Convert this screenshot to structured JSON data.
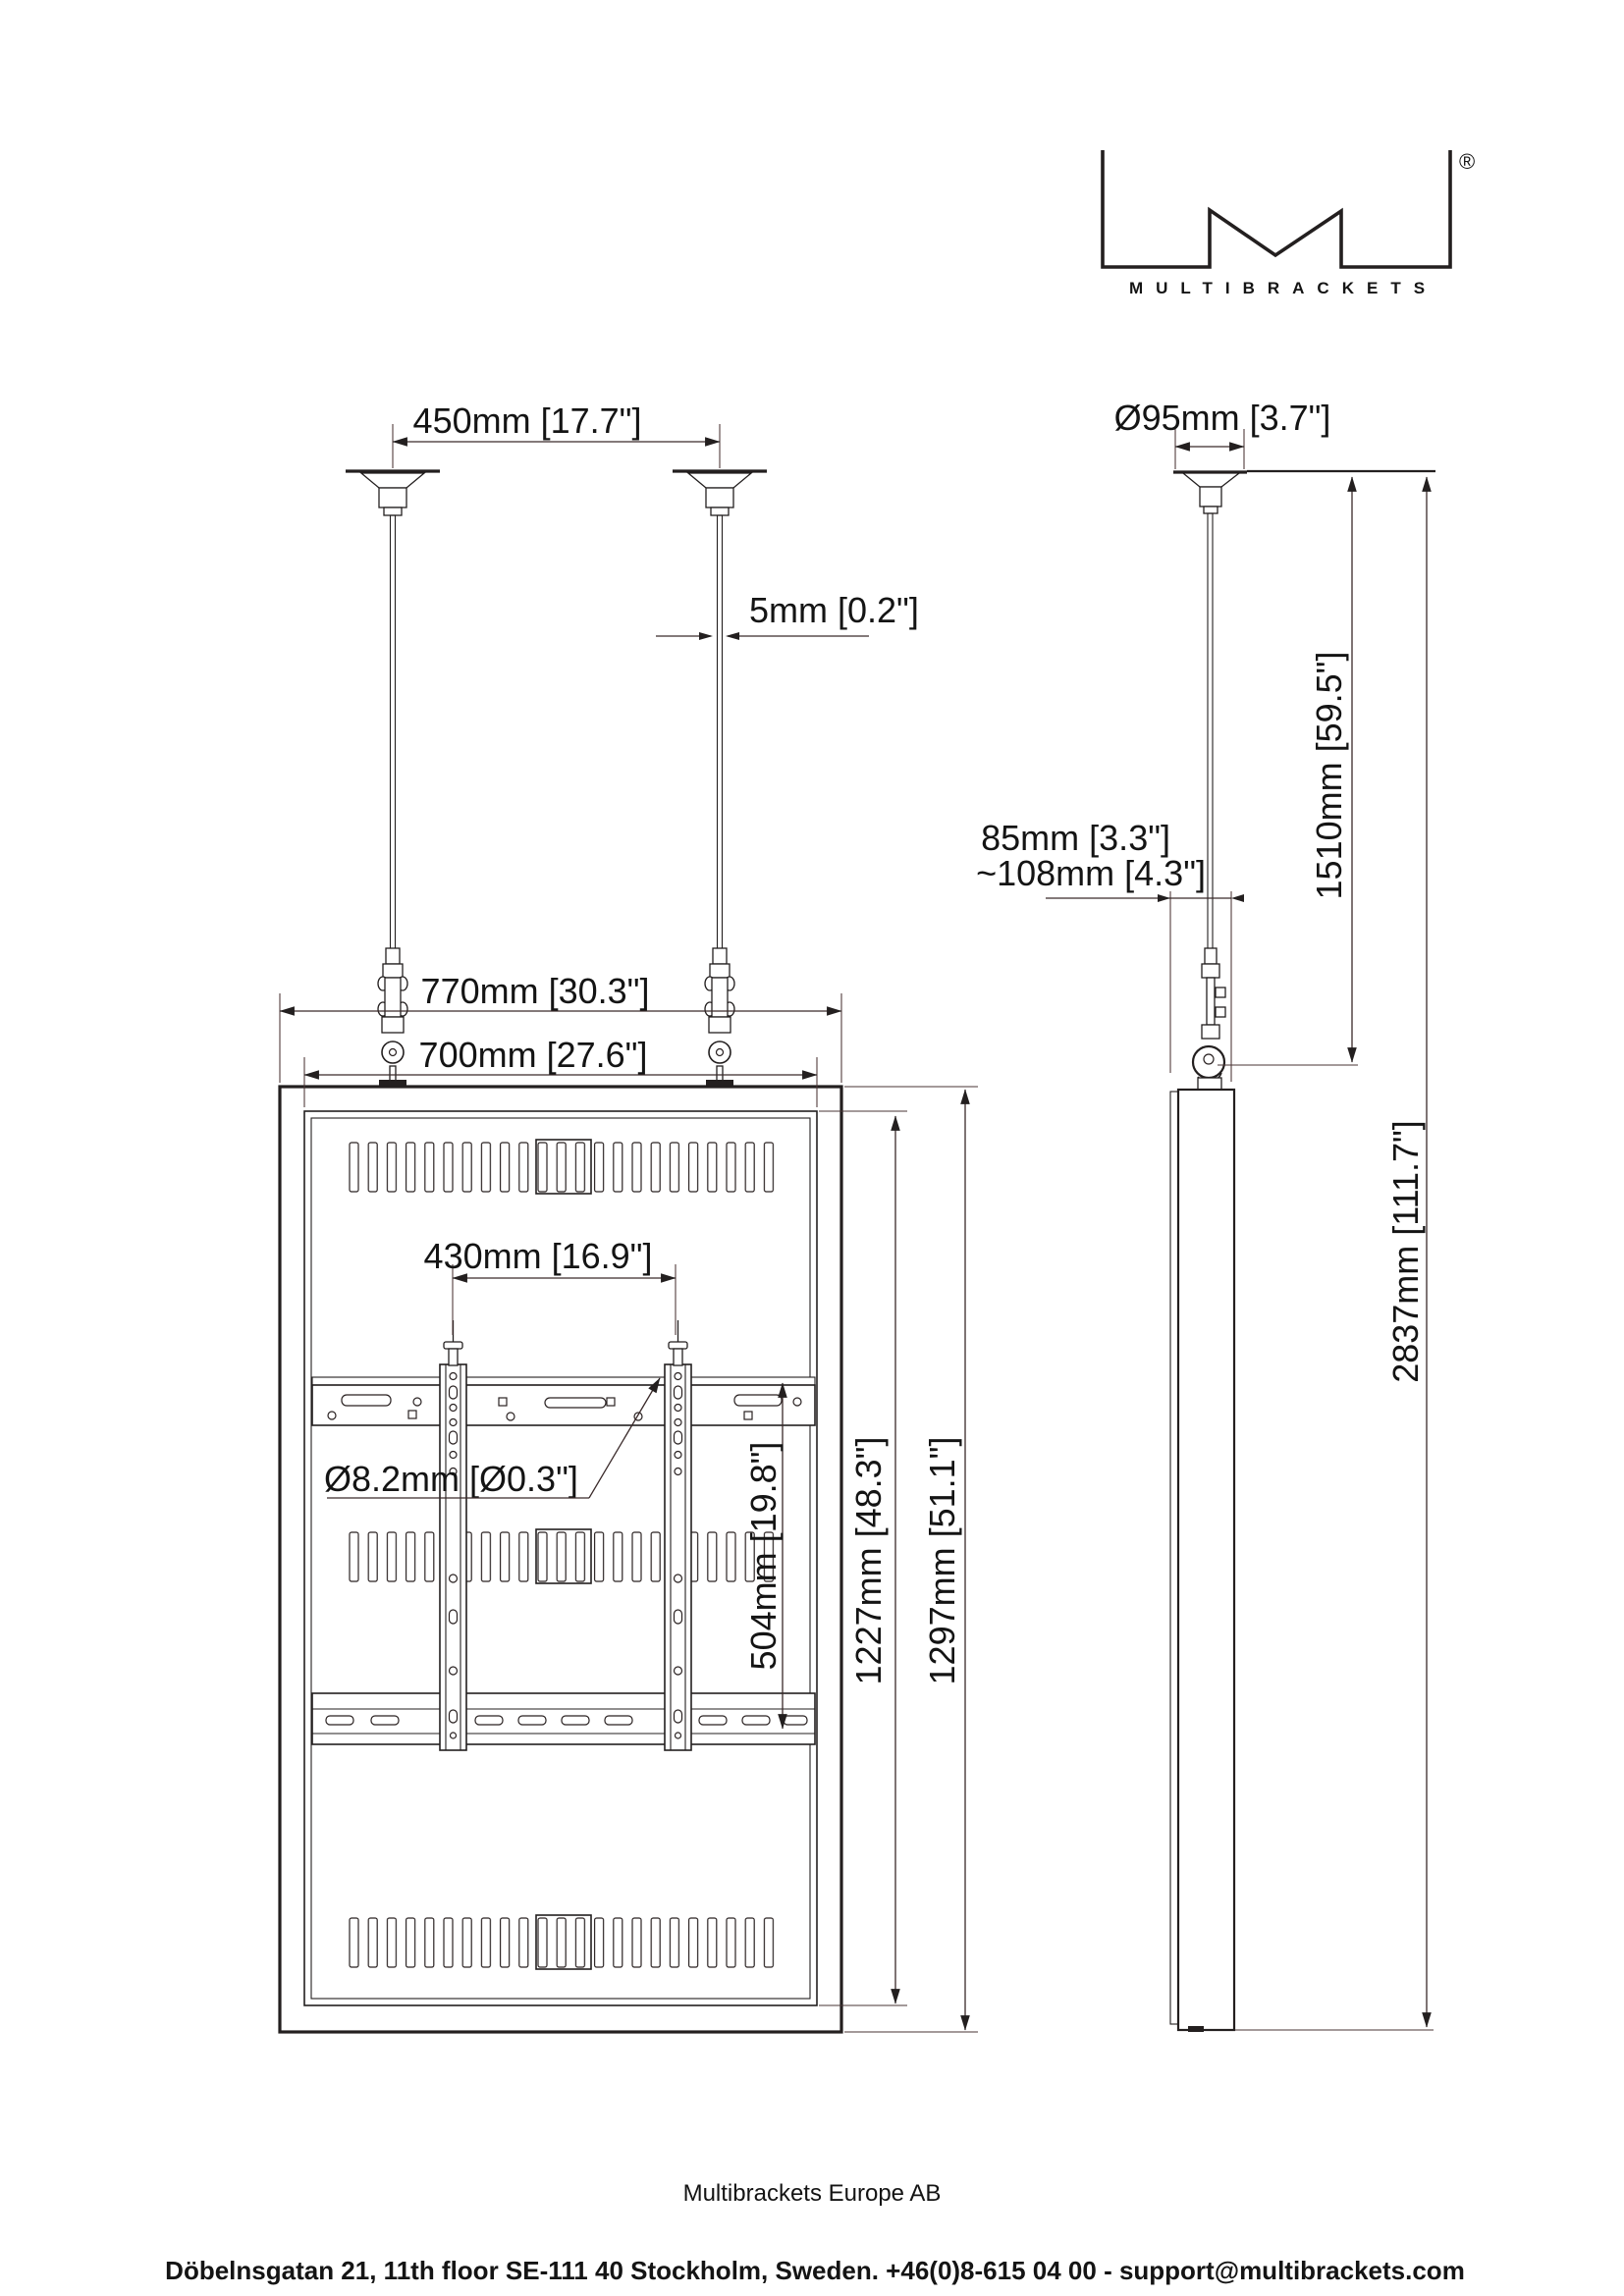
{
  "colors": {
    "line": "#231f1f",
    "text": "#141414",
    "background": "#ffffff"
  },
  "logo": {
    "brand": "MULTIBRACKETS",
    "registered_mark": "®"
  },
  "front_view": {
    "label_ceiling_spacing": "450mm [17.7\"]",
    "label_wire_diameter": "5mm [0.2\"]",
    "label_outer_width": "770mm [30.3\"]",
    "label_inner_width": "700mm [27.6\"]",
    "label_rail_spacing": "430mm [16.9\"]",
    "label_hole_diameter": "Ø8.2mm [Ø0.3\"]",
    "label_rail_height": "504mm [19.8\"]",
    "label_inner_height": "1227mm [48.3\"]",
    "label_outer_height": "1297mm [51.1\"]"
  },
  "side_view": {
    "label_plate_diameter": "Ø95mm [3.7\"]",
    "label_depth": "85mm [3.3\"]",
    "label_depth_with_hook": "~108mm [4.3\"]",
    "label_wire_drop": "1510mm [59.5\"]",
    "label_total_height": "2837mm [111.7\"]"
  },
  "footer": {
    "company": "Multibrackets Europe AB",
    "address": "Döbelnsgatan 21, 11th floor SE-111 40 Stockholm, Sweden. +46(0)8-615 04 00 - support@multibrackets.com"
  }
}
